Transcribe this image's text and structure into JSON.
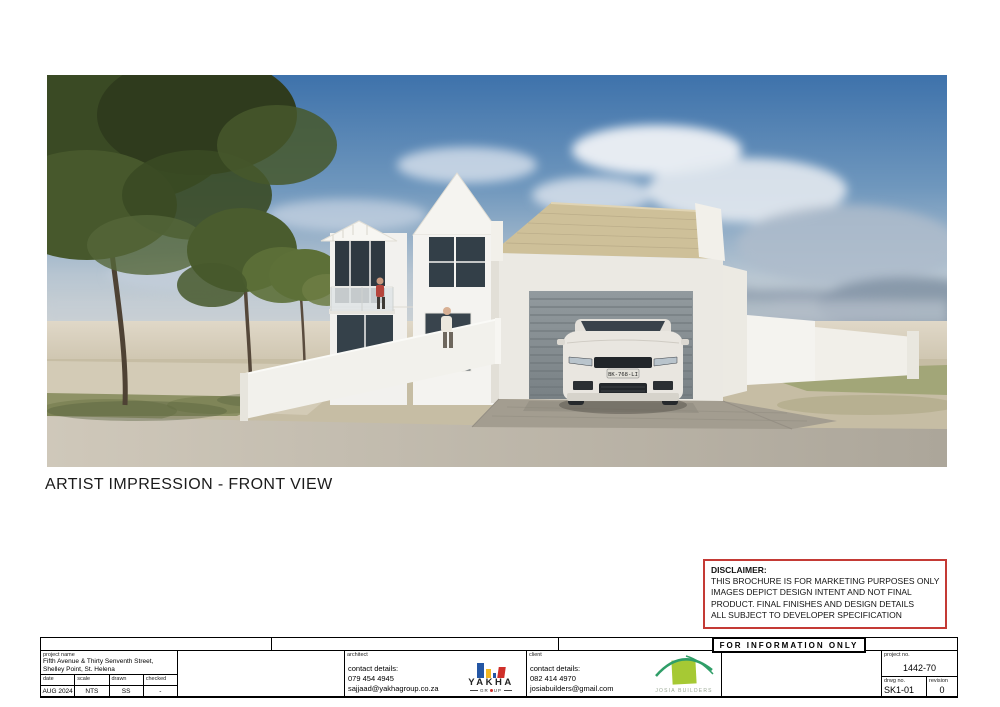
{
  "sheet": {
    "caption": "ARTIST IMPRESSION - FRONT VIEW"
  },
  "image": {
    "car_plate": "BK-768-LI"
  },
  "disclaimer": {
    "title": "DISCLAIMER:",
    "lines": [
      "THIS BROCHURE IS FOR MARKETING PURPOSES ONLY",
      "IMAGES DEPICT DESIGN INTENT AND NOT FINAL",
      "PRODUCT. FINAL FINISHES AND DESIGN DETAILS",
      "ALL SUBJECT TO DEVELOPER SPECIFICATION"
    ],
    "border_color": "#c43a35"
  },
  "stamp": {
    "text": "FOR INFORMATION ONLY"
  },
  "titleblock": {
    "project": {
      "label": "project name",
      "value": "Fifth Avenue & Thirty Senventh Street, Shelley Point, St. Helena"
    },
    "date": {
      "label": "date",
      "value": "AUG 2024"
    },
    "scale": {
      "label": "scale",
      "value": "NTS"
    },
    "drawn": {
      "label": "drawn",
      "value": "SS"
    },
    "checked": {
      "label": "checked",
      "value": "-"
    },
    "architect": {
      "label": "architect",
      "contact_label": "contact details:",
      "phone": "079 454 4945",
      "email": "sajjaad@yakhagroup.co.za"
    },
    "client": {
      "label": "client",
      "contact_label": "contact details:",
      "phone": "082 414 4970",
      "email": "josiabuilders@gmail.com"
    },
    "project_no": {
      "label": "project no.",
      "value": "1442-70"
    },
    "drawing_no": {
      "label": "drwg no.",
      "value": "SK1-01"
    },
    "revision": {
      "label": "revision",
      "value": "0"
    }
  },
  "logos": {
    "yakha": {
      "name": "YAKHA",
      "sub_left": "GR",
      "sub_right": "UP",
      "colors": {
        "blue": "#2456a4",
        "yellow": "#f2b722",
        "red": "#cf2f2a"
      }
    },
    "josia": {
      "name": "JOSIA BUILDERS",
      "colors": {
        "lime": "#a6c934",
        "teal": "#2f9e68",
        "text": "#9aa895"
      }
    }
  }
}
